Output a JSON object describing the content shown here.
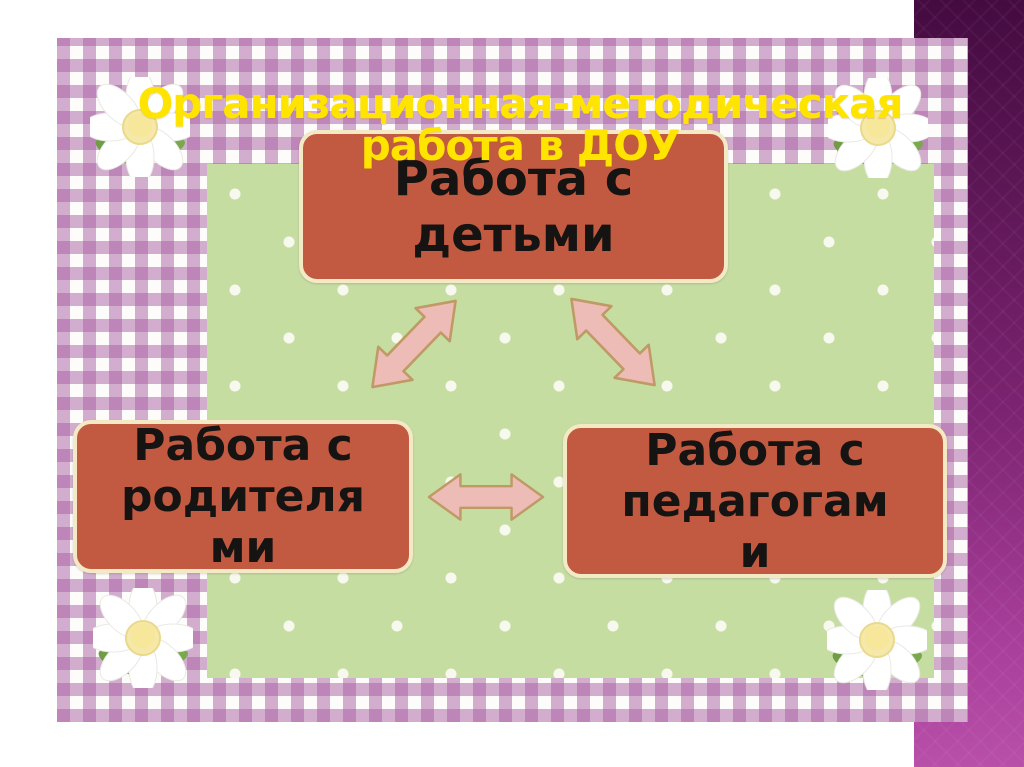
{
  "slide": {
    "title": {
      "text": "Организационная-методическая работа в ДОУ",
      "lines": [
        "Организационная-методическая",
        "работа в ДОУ"
      ]
    },
    "diagram": {
      "nodes": [
        {
          "id": "children",
          "label": "Работа с детьми",
          "lines": [
            "Работа с",
            "детьми"
          ]
        },
        {
          "id": "parents",
          "label": "Работа с родителями",
          "lines": [
            "Работа с",
            "родителя",
            "ми"
          ]
        },
        {
          "id": "teachers",
          "label": "Работа с педагогами",
          "lines": [
            "Работа с",
            "педагогам",
            "и"
          ]
        }
      ],
      "connections": [
        {
          "from": "children",
          "to": "parents",
          "type": "double-arrow"
        },
        {
          "from": "children",
          "to": "teachers",
          "type": "double-arrow"
        },
        {
          "from": "parents",
          "to": "teachers",
          "type": "double-arrow"
        }
      ]
    },
    "colors": {
      "title": "#ffe400",
      "node_fill": "#c25a41",
      "node_border": "#f3e9c5",
      "node_text": "#151413",
      "arrow_fill": "#eebcb6",
      "arrow_outline": "#bf9a66",
      "panel_green": "#c6dda2",
      "gingham_purple": "#b06aac",
      "side_bar_top": "#440b40",
      "side_bar_bottom": "#b84fa9"
    },
    "decorations": [
      "daisy-top-left",
      "daisy-top-right",
      "daisy-bottom-left",
      "daisy-bottom-right"
    ]
  }
}
